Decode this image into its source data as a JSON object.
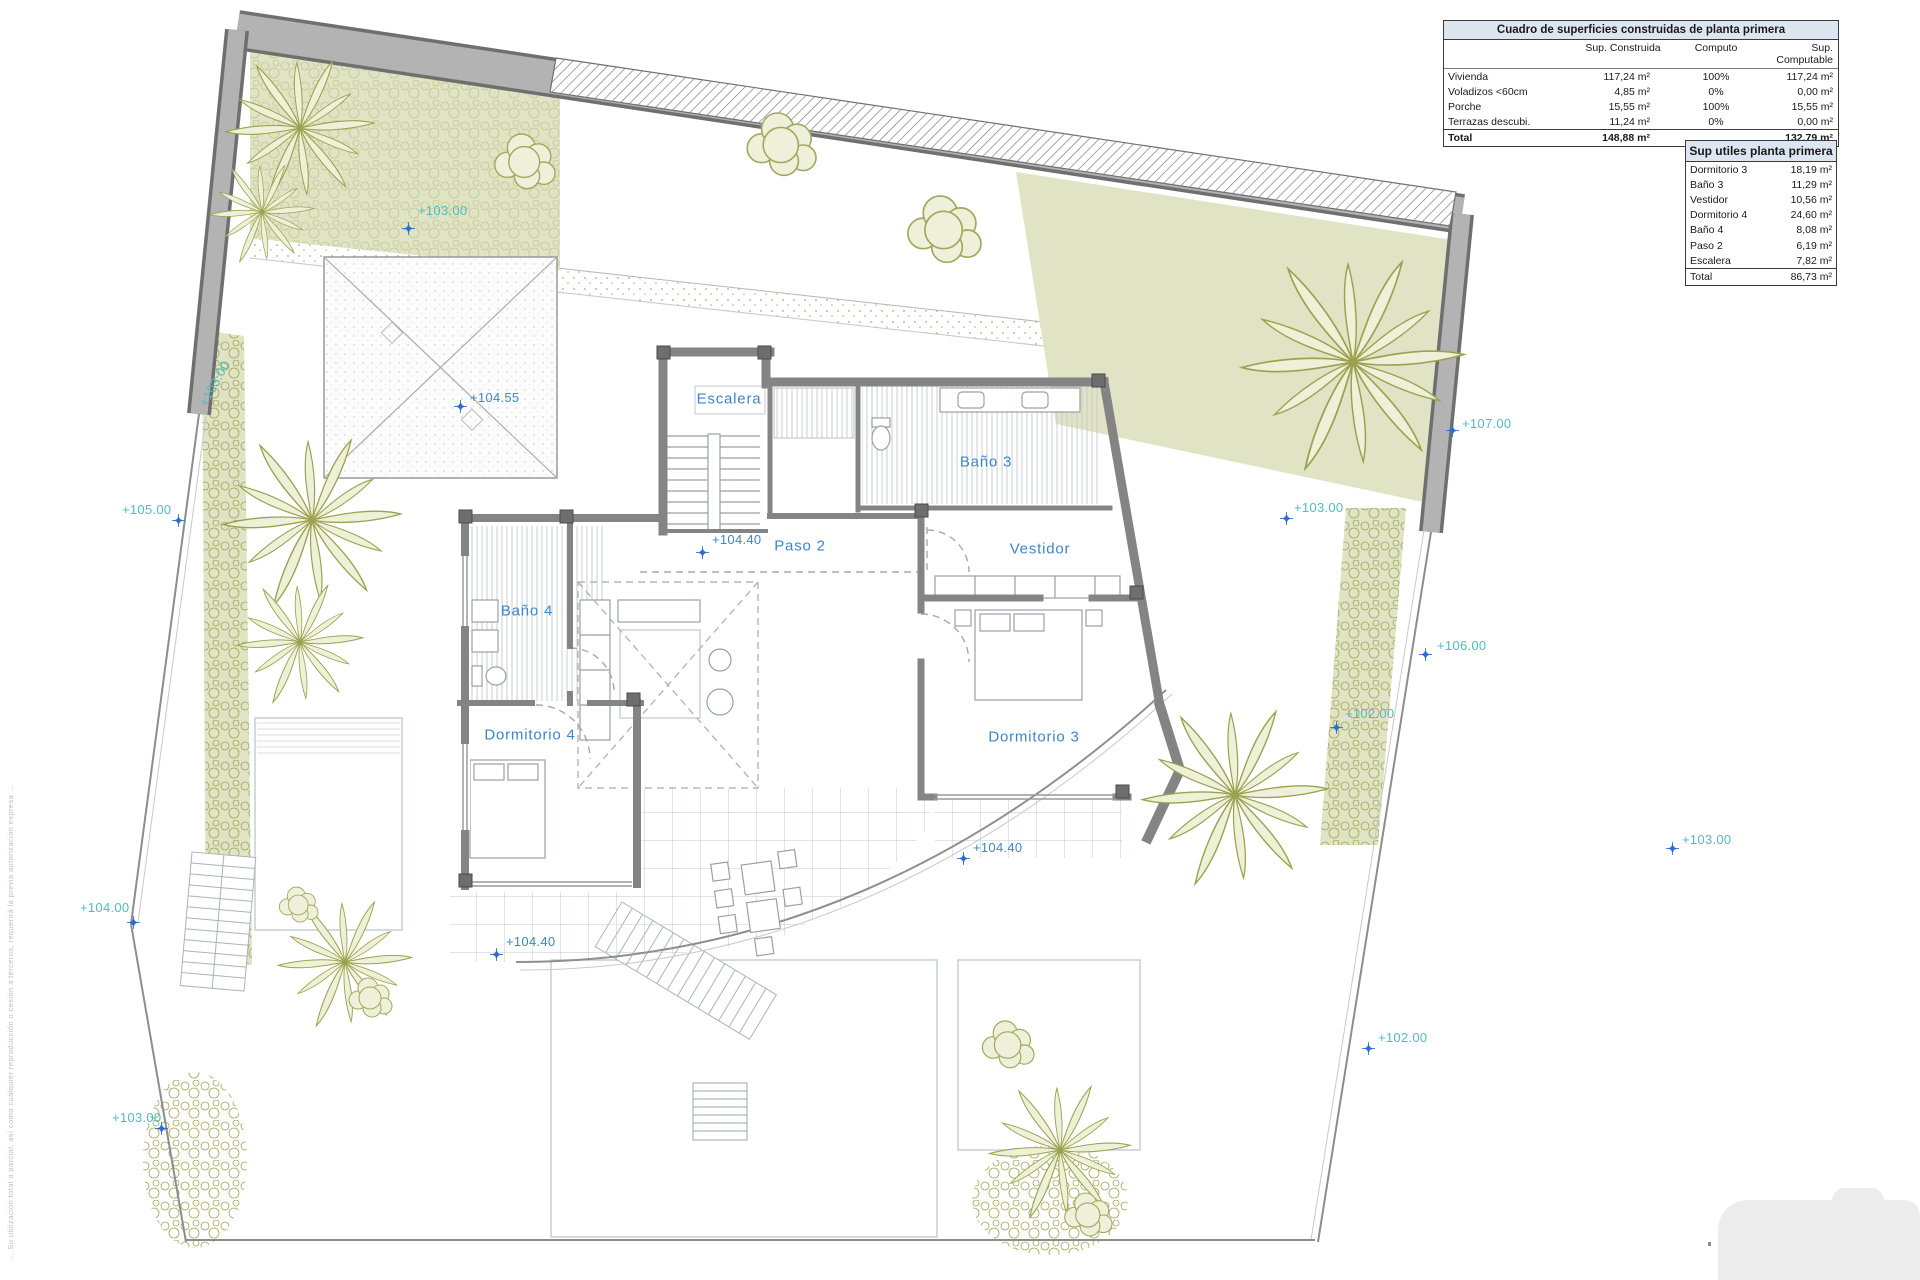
{
  "tables": {
    "construidas": {
      "title": "Cuadro de superficies construidas de planta primera",
      "col_headers": [
        "",
        "Sup. Construida",
        "Computo",
        "Sup. Computable"
      ],
      "rows": [
        {
          "label": "Vivienda",
          "sup_construida": "117,24 m²",
          "computo": "100%",
          "sup_computable": "117,24 m²"
        },
        {
          "label": "Voladizos <60cm",
          "sup_construida": "4,85 m²",
          "computo": "0%",
          "sup_computable": "0,00 m²"
        },
        {
          "label": "Porche",
          "sup_construida": "15,55 m²",
          "computo": "100%",
          "sup_computable": "15,55 m²"
        },
        {
          "label": "Terrazas descubi.",
          "sup_construida": "11,24 m²",
          "computo": "0%",
          "sup_computable": "0,00 m²"
        }
      ],
      "total": {
        "label": "Total",
        "sup_construida": "148,88 m²",
        "computo": "",
        "sup_computable": "132,79 m²"
      }
    },
    "utiles": {
      "title": "Sup utiles planta primera",
      "rows": [
        {
          "label": "Dormitorio 3",
          "value": "18,19 m²"
        },
        {
          "label": "Baño 3",
          "value": "11,29 m²"
        },
        {
          "label": "Vestidor",
          "value": "10,56 m²"
        },
        {
          "label": "Dormitorio 4",
          "value": "24,60 m²"
        },
        {
          "label": "Baño 4",
          "value": "8,08 m²"
        },
        {
          "label": "Paso 2",
          "value": "6,19 m²"
        },
        {
          "label": "Escalera",
          "value": "7,82 m²"
        }
      ],
      "total": {
        "label": "Total",
        "value": "86,73 m²"
      }
    }
  },
  "plan": {
    "room_labels": [
      {
        "text": "Escalera",
        "x": 729,
        "y": 399
      },
      {
        "text": "Paso 2",
        "x": 800,
        "y": 546
      },
      {
        "text": "Vestidor",
        "x": 1040,
        "y": 549
      },
      {
        "text": "Baño 3",
        "x": 986,
        "y": 462
      },
      {
        "text": "Baño 4",
        "x": 527,
        "y": 611
      },
      {
        "text": "Dormitorio 4",
        "x": 530,
        "y": 735
      },
      {
        "text": "Dormitorio 3",
        "x": 1034,
        "y": 737
      }
    ],
    "level_markers": [
      {
        "text": "+103.00",
        "tx": 418,
        "ty": 203,
        "ix": 402,
        "iy": 222,
        "color": "teal"
      },
      {
        "text": "+104.55",
        "tx": 470,
        "ty": 390,
        "ix": 454,
        "iy": 400,
        "color": "blue"
      },
      {
        "text": "+105.00",
        "tx": 122,
        "ty": 502,
        "ix": 172,
        "iy": 514,
        "color": "teal"
      },
      {
        "text": "+107.00",
        "tx": 1462,
        "ty": 416,
        "ix": 1446,
        "iy": 424,
        "color": "teal"
      },
      {
        "text": "+103.00",
        "tx": 1294,
        "ty": 500,
        "ix": 1280,
        "iy": 512,
        "color": "teal"
      },
      {
        "text": "+106.00",
        "tx": 1437,
        "ty": 638,
        "ix": 1419,
        "iy": 648,
        "color": "teal"
      },
      {
        "text": "+102.00",
        "tx": 1345,
        "ty": 706,
        "ix": 1330,
        "iy": 721,
        "color": "teal"
      },
      {
        "text": "+103.00",
        "tx": 1682,
        "ty": 832,
        "ix": 1666,
        "iy": 842,
        "color": "teal"
      },
      {
        "text": "+104.40",
        "tx": 712,
        "ty": 532,
        "ix": 696,
        "iy": 546,
        "color": "blue"
      },
      {
        "text": "+104.40",
        "tx": 973,
        "ty": 840,
        "ix": 957,
        "iy": 852,
        "color": "blue"
      },
      {
        "text": "+104.40",
        "tx": 506,
        "ty": 934,
        "ix": 490,
        "iy": 948,
        "color": "blue"
      },
      {
        "text": "+104.00",
        "tx": 80,
        "ty": 900,
        "ix": 127,
        "iy": 916,
        "color": "teal"
      },
      {
        "text": "+102.00",
        "tx": 1378,
        "ty": 1030,
        "ix": 1362,
        "iy": 1042,
        "color": "teal"
      },
      {
        "text": "+103.00",
        "tx": 112,
        "ty": 1110,
        "ix": 155,
        "iy": 1122,
        "color": "teal"
      },
      {
        "text": "+103.00",
        "tx": 196,
        "ty": 402,
        "rot": -62,
        "color": "teal"
      }
    ]
  },
  "side_note": {
    "text": "… Su utilización total o parcial, así como cualquier reproducción o cesión a terceros, requerirá la previa autorización expresa …"
  },
  "colors": {
    "accent_teal": "#4cbec0",
    "label_blue": "#3c86c8",
    "marker_blue": "#2e6bd0",
    "green_fill": "#e0e3c4",
    "olive": "#9fa455",
    "band_gray": "#b3b3b3",
    "wall_gray": "#848484",
    "table_header_fill": "#dce6f1"
  }
}
